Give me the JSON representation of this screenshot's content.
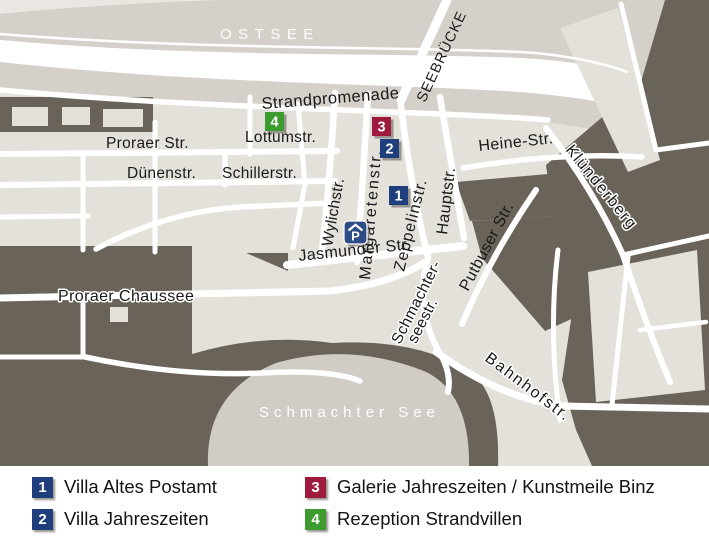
{
  "map": {
    "sea_label": "OSTSEE",
    "lake_label": "Schmachter See",
    "pier_label": "SEEBRÜCKE",
    "street_labels": {
      "strandpromenade": "Strandpromenade",
      "proraer_str": "Proraer Str.",
      "lottumstr": "Lottumstr.",
      "duenenstr": "Dünenstr.",
      "schillerstr": "Schillerstr.",
      "wylichstr": "Wylichstr.",
      "margaretenstr": "Margaretenstr.",
      "zeppelinstr": "Zeppelinstr.",
      "hauptstr": "Hauptstr.",
      "heine_str": "Heine-Str.",
      "kluenderberg": "Klünderberg",
      "putbuser_str": "Putbuser Str.",
      "jasmunder_str": "Jasmunder Str.",
      "schmachterseestr_line1": "Schmachter-",
      "schmachterseestr_line2": "seestr.",
      "proraer_chaussee": "Proraer Chaussee",
      "bahnhofstr": "Bahnhofstr."
    },
    "parking_icon_label": "P",
    "markers": [
      {
        "number": "1",
        "color": "#1e3f7c"
      },
      {
        "number": "2",
        "color": "#1e3f7c"
      },
      {
        "number": "3",
        "color": "#9e1b3d"
      },
      {
        "number": "4",
        "color": "#3d9b30"
      }
    ]
  },
  "legend": {
    "items": [
      {
        "number": "1",
        "color": "#1e3f7c",
        "label": "Villa Altes Postamt"
      },
      {
        "number": "2",
        "color": "#1e3f7c",
        "label": "Villa Jahreszeiten"
      },
      {
        "number": "3",
        "color": "#9e1b3d",
        "label": "Galerie Jahreszeiten / Kunstmeile Binz"
      },
      {
        "number": "4",
        "color": "#3d9b30",
        "label": "Rezeption Strandvillen"
      }
    ]
  },
  "colors": {
    "sea": "#d5d0c9",
    "lake": "#d1ccc6",
    "city_block": "#e4e1db",
    "forest": "#6a635a",
    "street": "#ffffff",
    "label_dark": "#1a1a1a",
    "label_light": "#ffffff",
    "parking_blue": "#2d4c86"
  }
}
